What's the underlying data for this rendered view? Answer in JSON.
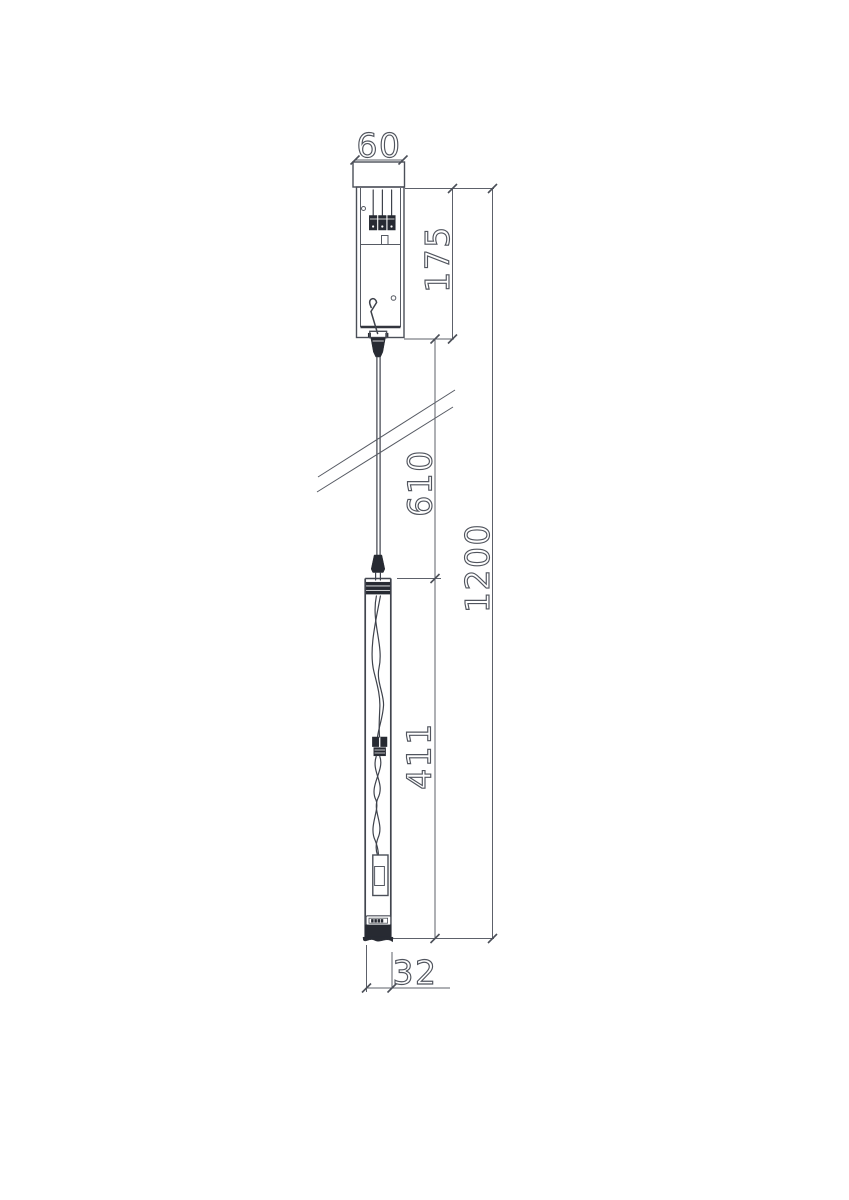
{
  "drawing": {
    "background_color": "#ffffff",
    "line_color": "#4b4f58",
    "component_fill_color": "#272a32",
    "dimension_text_style": "outline",
    "dimensions": {
      "canopy_width_mm": "60",
      "canopy_height_mm": "175",
      "suspension_length_mm": "610",
      "overall_height_mm": "1200",
      "lamp_body_height_mm": "411",
      "lamp_diameter_mm": "32"
    }
  }
}
